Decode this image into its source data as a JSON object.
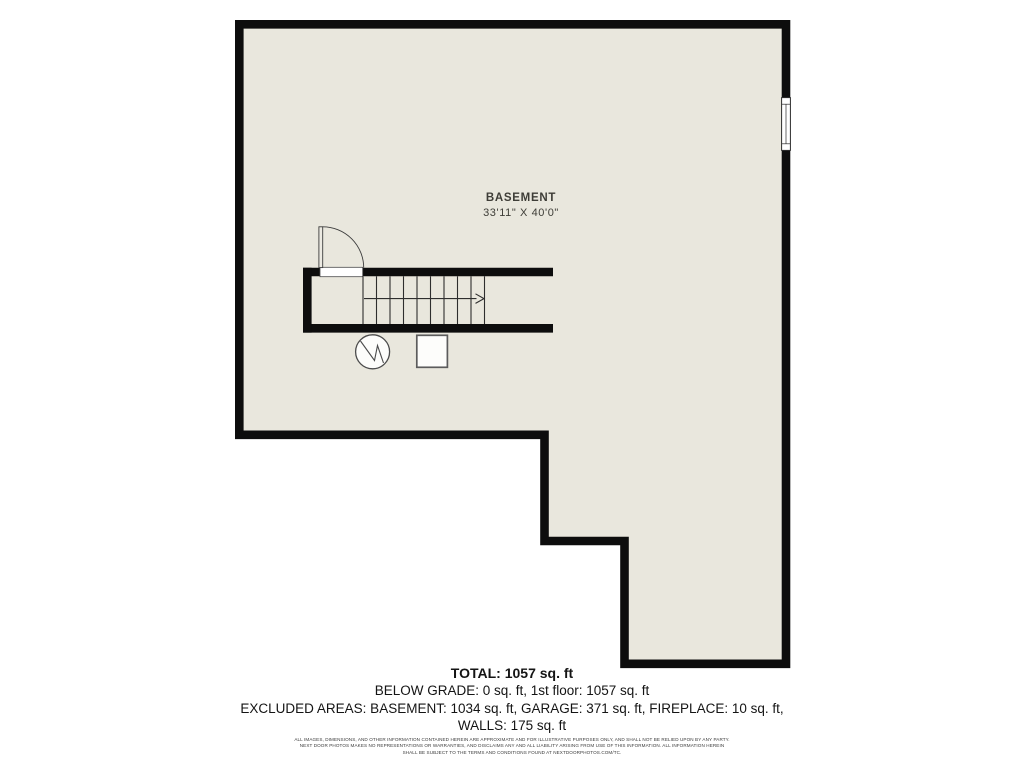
{
  "plan": {
    "room_label": "BASEMENT",
    "room_dimensions": "33'11\" X 40'0\"",
    "symbols": [
      "stairs-up-arrow",
      "door-swing",
      "window",
      "water-heater",
      "furnace"
    ]
  },
  "colors": {
    "floor_fill": "#e9e7dd",
    "wall": "#0d0d0d",
    "line": "#2e2e2e",
    "background": "#ffffff"
  },
  "summary": {
    "total": "TOTAL: 1057 sq. ft",
    "below_grade": "BELOW GRADE: 0 sq. ft, 1st floor: 1057 sq. ft",
    "excluded_line1": "EXCLUDED AREAS: BASEMENT: 1034 sq. ft, GARAGE: 371 sq. ft, FIREPLACE: 10 sq. ft,",
    "excluded_line2": "WALLS: 175 sq. ft"
  },
  "disclaimer": {
    "line1": "ALL IMAGES, DIMENSIONS, AND OTHER INFORMATION CONTAINED HEREIN ARE APPROXIMATE AND FOR ILLUSTRATIVE PURPOSES ONLY, AND SHALL NOT BE RELIED UPON BY ANY PARTY.",
    "line2": "NEXT DOOR PHOTOS MAKES NO REPRESENTATIONS OR WARRANTIES, AND DISCLAIMS ANY AND ALL LIABILITY ARISING FROM USE OF THIS INFORMATION. ALL INFORMATION HEREIN",
    "line3": "SHALL BE SUBJECT TO THE TERMS AND CONDITIONS FOUND AT NEXTDOORPHOTOS.COM/TC."
  }
}
